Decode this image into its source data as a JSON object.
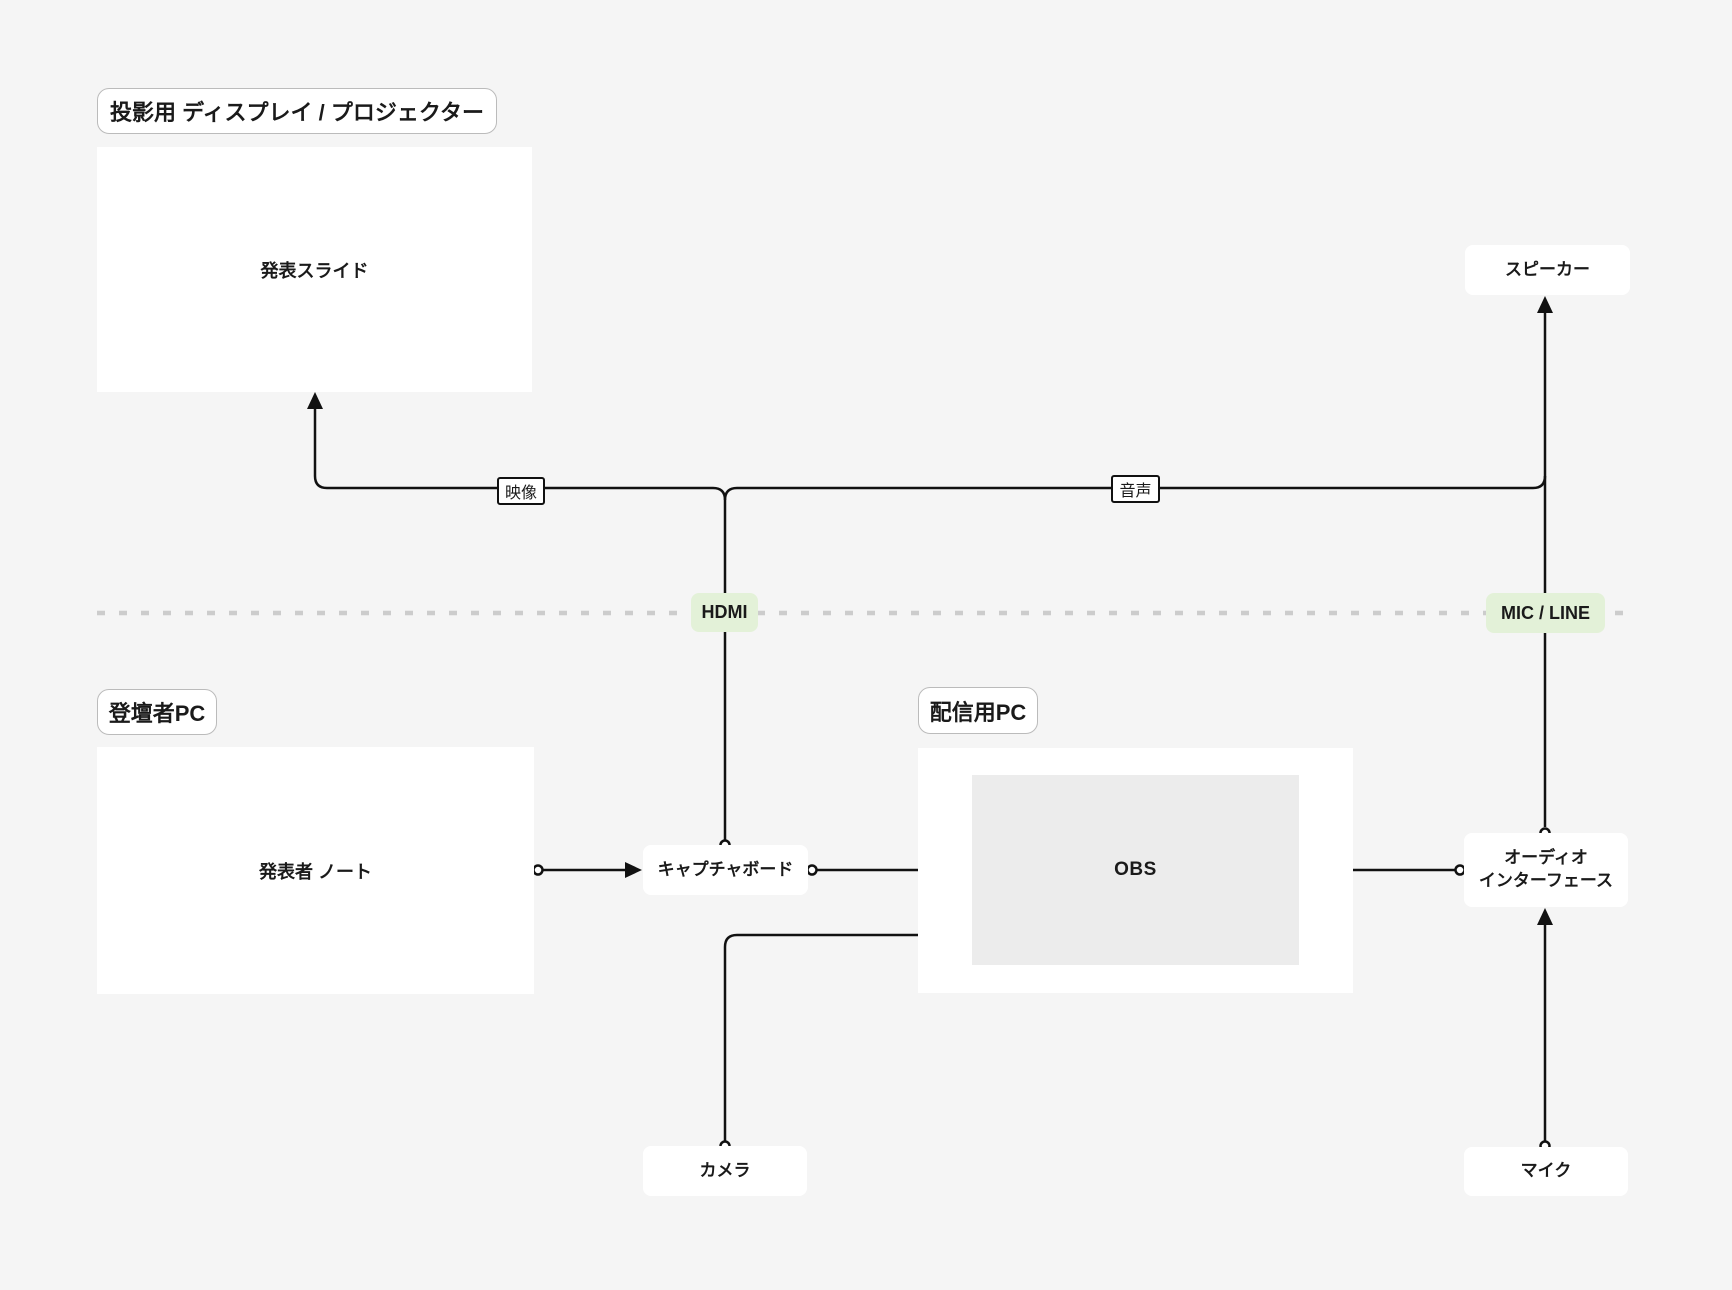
{
  "diagram_title": "presentation-streaming-av-setup",
  "sections": {
    "projector": {
      "label": "投影用 ディスプレイ / プロジェクター"
    },
    "presenter_pc": {
      "label": "登壇者PC"
    },
    "streaming_pc": {
      "label": "配信用PC"
    }
  },
  "nodes": {
    "slides": {
      "label": "発表スライド"
    },
    "speaker": {
      "label": "スピーカー"
    },
    "presenter_notes": {
      "label": "発表者 ノート"
    },
    "capture_board": {
      "label": "キャプチャボード"
    },
    "obs": {
      "label": "OBS"
    },
    "audio_interface": {
      "label_line1": "オーディオ",
      "label_line2": "インターフェース"
    },
    "camera": {
      "label": "カメラ"
    },
    "mic": {
      "label": "マイク"
    }
  },
  "edge_labels": {
    "video": "映像",
    "audio": "音声",
    "hdmi": "HDMI",
    "mic_line": "MIC / LINE"
  },
  "connections": [
    {
      "from": "presenter_notes",
      "to": "capture_board",
      "via": "HDMI",
      "marker_start": "circle",
      "marker_end": "arrow"
    },
    {
      "from": "capture_board",
      "to": "obs",
      "marker_start": "circle",
      "marker_end": "arrow"
    },
    {
      "from": "capture_board",
      "to": "slides",
      "label": "映像",
      "marker_start": "circle",
      "marker_end": "arrow"
    },
    {
      "from": "capture_board",
      "to": "speaker",
      "label": "音声",
      "marker_start": "circle",
      "marker_end": "arrow"
    },
    {
      "from": "camera",
      "to": "obs",
      "marker_start": "circle",
      "marker_end": "arrow"
    },
    {
      "from": "audio_interface",
      "to": "obs",
      "marker_start": "circle",
      "marker_end": "arrow"
    },
    {
      "from": "mic",
      "to": "audio_interface",
      "via": "MIC / LINE",
      "marker_start": "circle",
      "marker_end": "arrow"
    },
    {
      "from": "audio_interface",
      "to": "speaker",
      "marker_start": "circle",
      "marker_end": "arrow"
    }
  ],
  "colors": {
    "background": "#f5f5f5",
    "node_fill": "#ffffff",
    "obs_fill": "#ececec",
    "edge": "#111111",
    "green_label": "#e3f1d8",
    "dashed_divider": "#cccccc",
    "section_border": "#bbbbbb",
    "text": "#1a1a1a"
  }
}
